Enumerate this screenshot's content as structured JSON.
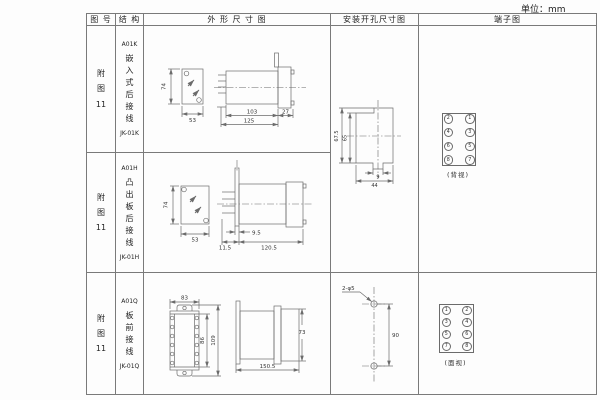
{
  "unit": "单位：mm",
  "header": {
    "figure": "图 号",
    "structure": "结 构",
    "outline": "外 形 尺 寸 图",
    "mounting": "安装开孔尺寸图",
    "terminal": "端子图"
  },
  "row1": {
    "figure": "附\n图\n11",
    "model": "A01K",
    "structure": "嵌入式后接线",
    "code": "JK-01K",
    "dims": {
      "h": "74",
      "w": "53",
      "body": "103",
      "total": "125",
      "flange": "27"
    }
  },
  "row2": {
    "figure": "附\n图\n11",
    "model": "A01H",
    "structure": "凸出板后接线",
    "code": "JK-01H",
    "dims": {
      "h": "74",
      "w": "53",
      "plate": "9.5",
      "front": "11.5",
      "body": "120.5"
    }
  },
  "row3": {
    "figure": "附\n图\n11",
    "model": "A01Q",
    "structure": "板前接线",
    "code": "JK-01Q",
    "dims": {
      "w": "83",
      "inner_h": "86",
      "outer_h": "109",
      "side_h": "73",
      "length": "150.5"
    }
  },
  "mounting_k": {
    "outer": "67.5",
    "inner": "65",
    "notch": "9",
    "width": "44"
  },
  "mounting_q": {
    "holes": "2-φ5",
    "spacing": "90"
  },
  "terminal_k": {
    "cells": [
      "2",
      "1",
      "4",
      "3",
      "6",
      "5",
      "8",
      "7"
    ],
    "view": "(背视)"
  },
  "terminal_q": {
    "cells": [
      "1",
      "2",
      "3",
      "4",
      "5",
      "6",
      "7",
      "8"
    ],
    "view": "(面视)"
  }
}
